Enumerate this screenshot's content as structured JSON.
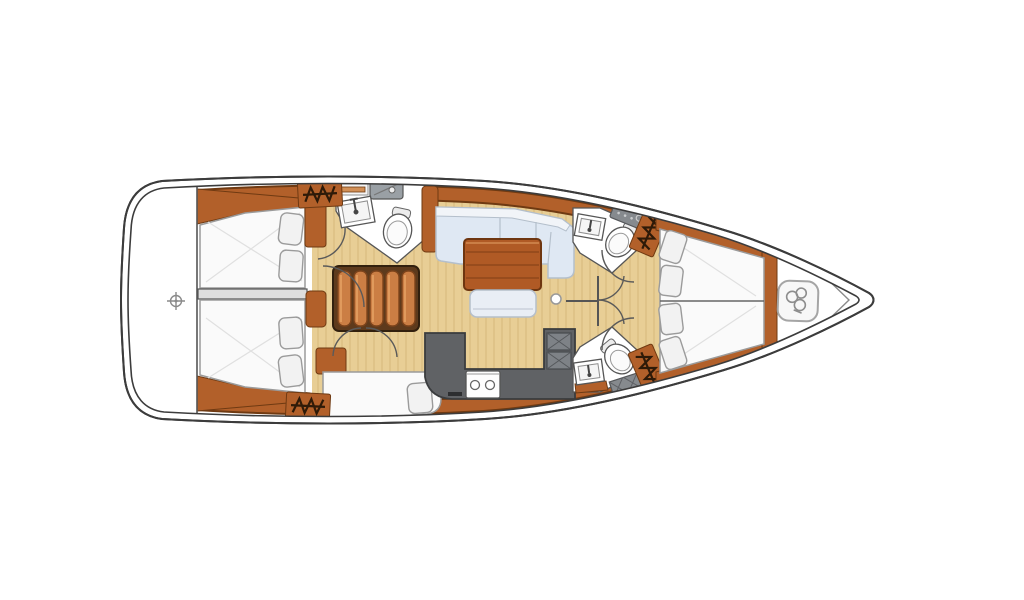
{
  "meta": {
    "description": "Top-down interior layout plan of a sailing yacht, bow pointing right, no text labels rendered",
    "diagram_type": "yacht-interior-floor-plan"
  },
  "palette": {
    "hull-line": "#3c3c3c",
    "wood": "#b2602a",
    "wood-dark": "#6f3a12",
    "wood-light": "#d29057",
    "floor": "#e8ce95",
    "floor-line": "#d6b87c",
    "berth": "#fafafa",
    "berth-edge": "#9b9b9b",
    "pillow": "#f2f2f2",
    "sofa": "#dfe8f3",
    "sofa-edge": "#b4bfcb",
    "sofa-back": "#f1f4f8",
    "counter": "#606265",
    "counter-edge": "#3a3c3e",
    "fixture-edge": "#565656",
    "shower": "#868a8e",
    "step": "#cb7e44",
    "step-edge": "#7c431b",
    "table": "#b05a25",
    "table-edge": "#6e3610",
    "door-arc": "#5a5a5a",
    "symbol": "#8a8a8a"
  },
  "areas": [
    {
      "id": "transom-platform",
      "icons": [
        "datum-icon"
      ]
    },
    {
      "id": "aft-cabin-port",
      "fixtures": [
        "double-berth"
      ],
      "pillows": 2
    },
    {
      "id": "aft-cabin-starboard",
      "fixtures": [
        "double-berth",
        "extension-berth"
      ],
      "pillows": 3
    },
    {
      "id": "aft-head",
      "fixtures": [
        "shower-panel",
        "washbasin",
        "toilet",
        "shelf"
      ]
    },
    {
      "id": "companionway-stairs",
      "steps": 5
    },
    {
      "id": "salon",
      "fixtures": [
        "l-shaped-sofa",
        "wood-table",
        "stool",
        "table-post"
      ]
    },
    {
      "id": "galley",
      "fixtures": [
        "l-counter",
        "stove-2-burners",
        "double-sink",
        "fridge"
      ]
    },
    {
      "id": "forward-head-port",
      "fixtures": [
        "washbasin",
        "toilet",
        "shower-tray"
      ]
    },
    {
      "id": "forward-head-starboard",
      "fixtures": [
        "washbasin",
        "toilet",
        "shower-grate"
      ]
    },
    {
      "id": "forward-cabin",
      "fixtures": [
        "v-berth"
      ],
      "pillows": 4
    },
    {
      "id": "foredeck-anchor-locker",
      "icons": [
        "windlass-icon"
      ]
    }
  ],
  "icons": {
    "hanging-locker": "zigzag-hanger-symbol",
    "datum": "crosshair-circle",
    "windlass": "rounded-plate-with-chain-gypsy"
  },
  "counts": {
    "hanging_lockers": 4,
    "doors_swing_arcs": 8,
    "cabins": 3,
    "heads": 3
  }
}
